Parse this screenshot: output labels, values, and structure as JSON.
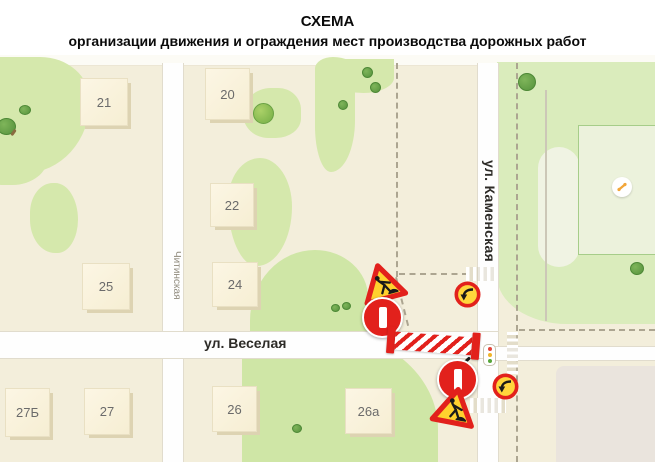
{
  "title": {
    "line1": "СХЕМА",
    "line2": "организации движения и ограждения мест производства дорожных работ"
  },
  "map": {
    "street_labels": {
      "chitinskaya": "Читинская",
      "veselaya": "ул. Веселая",
      "kamenskaya": "ул. Каменская"
    },
    "buildings": [
      {
        "number": "21"
      },
      {
        "number": "20"
      },
      {
        "number": "22"
      },
      {
        "number": "25"
      },
      {
        "number": "24"
      },
      {
        "number": "27Б"
      },
      {
        "number": "27"
      },
      {
        "number": "26"
      },
      {
        "number": "26а"
      }
    ],
    "signs": {
      "icons": [
        "road-works-sign",
        "no-entry-sign",
        "turn-restriction-sign",
        "striped-barrier",
        "traffic-light-icon",
        "pedestrian-crossing",
        "playground-icon",
        "tree-icon"
      ]
    },
    "colors": {
      "sign_red": "#e2211c",
      "sign_yellow": "#ffd12e",
      "map_beige": "#f3eedb",
      "map_green": "#d5e8ac",
      "road_white": "#fefefe"
    }
  }
}
